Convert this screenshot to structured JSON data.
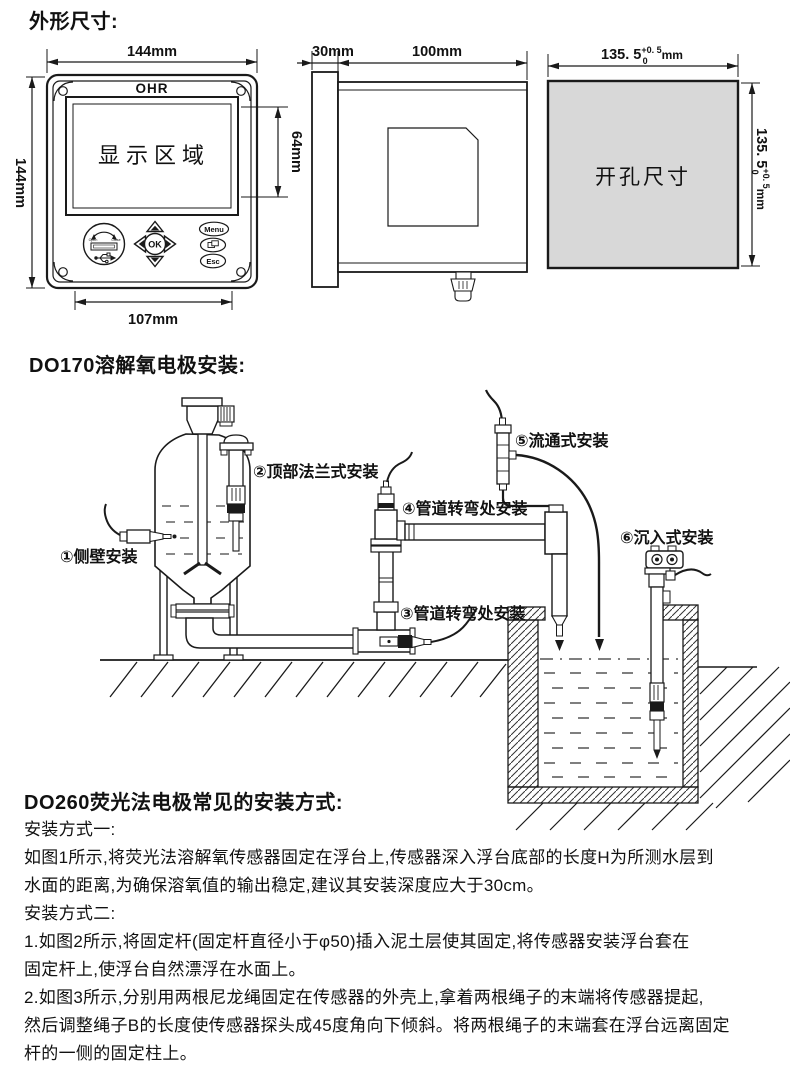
{
  "page": {
    "ink": "#1a1a1a",
    "cutout_fill": "#d8d8d8"
  },
  "sections": {
    "dimensions": {
      "title": "外形尺寸:",
      "front_view": {
        "brand": "OHR",
        "display_label": "显示区域",
        "width_top": "144mm",
        "height_left": "144mm",
        "display_height": "64mm",
        "width_bottom": "107mm",
        "buttons": {
          "ok": "OK",
          "menu": "Menu",
          "esc": "Esc",
          "usb_open": "Open",
          "usb_close": "Close"
        }
      },
      "side_view": {
        "bezel": "30mm",
        "depth": "100mm"
      },
      "cutout_view": {
        "area_label": "开孔尺寸",
        "value": "135. 5",
        "tol_upper": "+0. 5",
        "tol_lower": "0",
        "unit": "mm"
      }
    },
    "do170": {
      "title": "DO170溶解氧电极安装:",
      "labels": {
        "l1": "①侧壁安装",
        "l2": "②顶部法兰式安装",
        "l3": "③管道转弯处安装",
        "l4": "④管道转弯处安装",
        "l5": "⑤流通式安装",
        "l6": "⑥沉入式安装"
      }
    },
    "do260": {
      "title": "DO260荧光法电极常见的安装方式:",
      "lines": [
        "安装方式一:",
        "如图1所示,将荧光法溶解氧传感器固定在浮台上,传感器深入浮台底部的长度H为所测水层到",
        "水面的距离,为确保溶氧值的输出稳定,建议其安装深度应大于30cm。",
        "安装方式二:",
        "1.如图2所示,将固定杆(固定杆直径小于φ50)插入泥土层使其固定,将传感器安装浮台套在",
        "固定杆上,使浮台自然漂浮在水面上。",
        "2.如图3所示,分别用两根尼龙绳固定在传感器的外壳上,拿着两根绳子的末端将传感器提起,",
        "然后调整绳子B的长度使传感器探头成45度角向下倾斜。将两根绳子的末端套在浮台远离固定",
        "杆的一侧的固定柱上。"
      ]
    }
  }
}
